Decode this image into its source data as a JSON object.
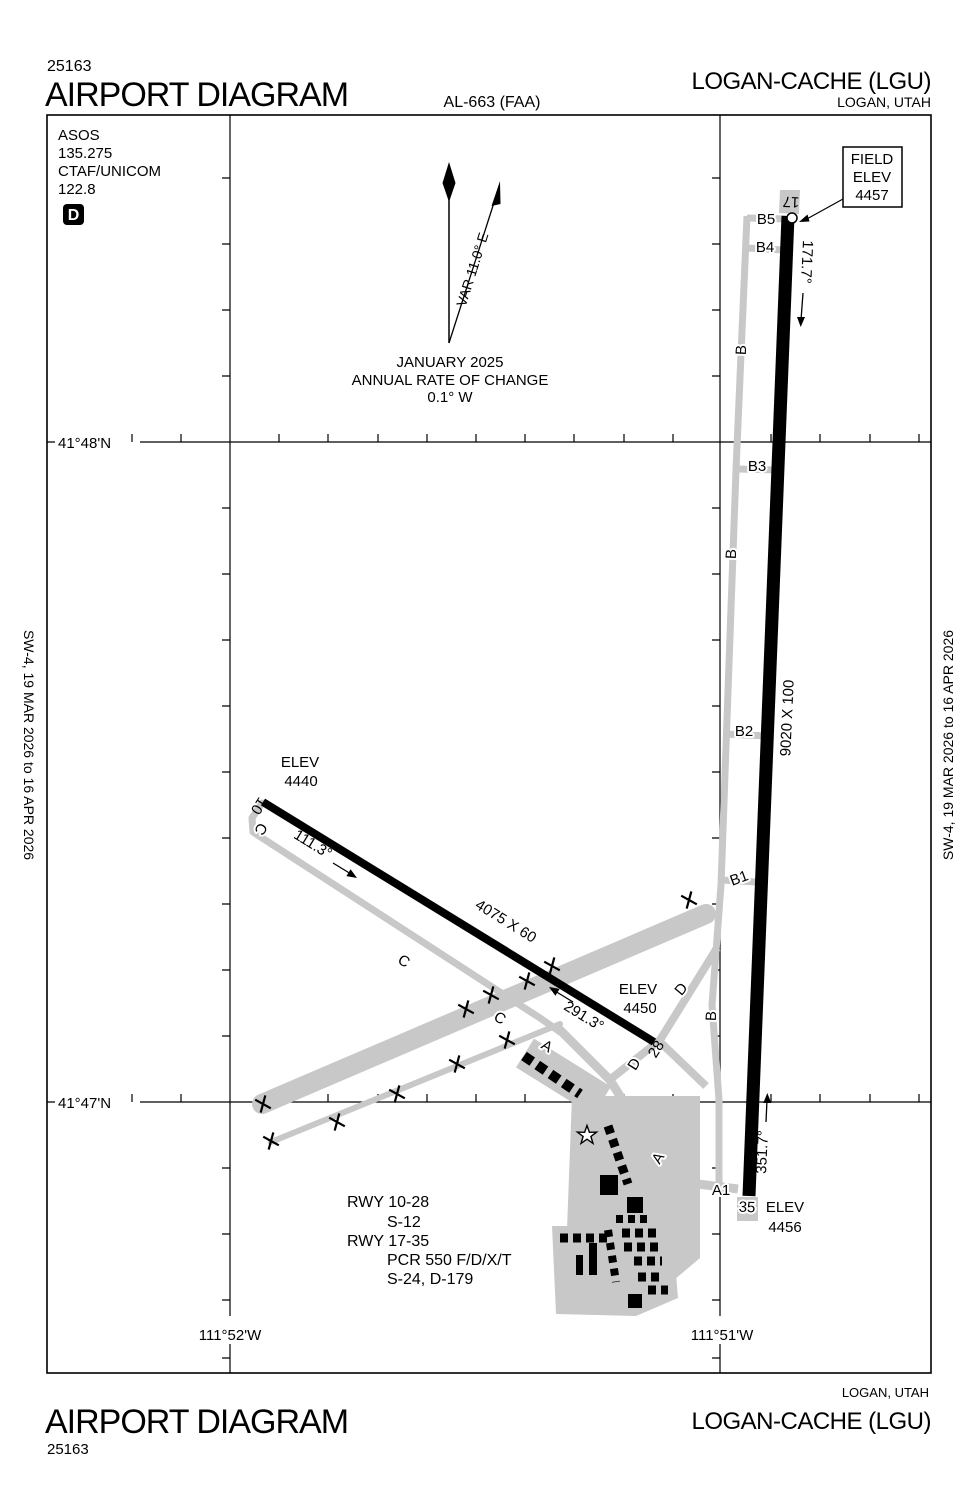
{
  "header": {
    "page_code": "25163",
    "title": "AIRPORT DIAGRAM",
    "al_ref": "AL-663 (FAA)",
    "airport": "LOGAN-CACHE (LGU)",
    "city": "LOGAN, UTAH"
  },
  "footer": {
    "title": "AIRPORT DIAGRAM",
    "page_code": "25163",
    "airport": "LOGAN-CACHE (LGU)",
    "city": "LOGAN, UTAH"
  },
  "margin_note": "SW-4, 19 MAR 2026 to 16 APR 2026",
  "comms": {
    "asos_label": "ASOS",
    "asos_freq": "135.275",
    "ctaf_label": "CTAF/UNICOM",
    "ctaf_freq": "122.8",
    "airport_diagram_symbol": "D"
  },
  "compass": {
    "variation": "VAR 11.0° E",
    "date": "JANUARY 2025",
    "rate_label": "ANNUAL RATE OF CHANGE",
    "rate_value": "0.1° W"
  },
  "field_elev": {
    "line1": "FIELD",
    "line2": "ELEV",
    "value": "4457"
  },
  "grid": {
    "lat_north": "41°48'N",
    "lat_south": "41°47'N",
    "lon_west": "111°52'W",
    "lon_east": "111°51'W"
  },
  "runway_17_35": {
    "number_north": "17",
    "number_south": "35",
    "dimensions": "9020 X 100",
    "heading_south": "171.7°",
    "heading_north": "351.7°"
  },
  "runway_10_28": {
    "number_west": "10",
    "number_east": "28",
    "dimensions": "4075 X 60",
    "heading_east": "111.3°",
    "heading_west": "291.3°"
  },
  "elevations": {
    "label": "ELEV",
    "rwy10_end": "4440",
    "rwy28_end": "4450",
    "rwy35_end": "4456"
  },
  "taxiways": {
    "b5": "B5",
    "b4": "B4",
    "b3": "B3",
    "b2": "B2",
    "b1": "B1",
    "b": "B",
    "c": "C",
    "d": "D",
    "a": "A",
    "a1": "A1"
  },
  "runway_info": {
    "line1": "RWY 10-28",
    "line2": "S-12",
    "line3": "RWY 17-35",
    "line4": "PCR 550 F/D/X/T",
    "line5": "S-24, D-179"
  }
}
